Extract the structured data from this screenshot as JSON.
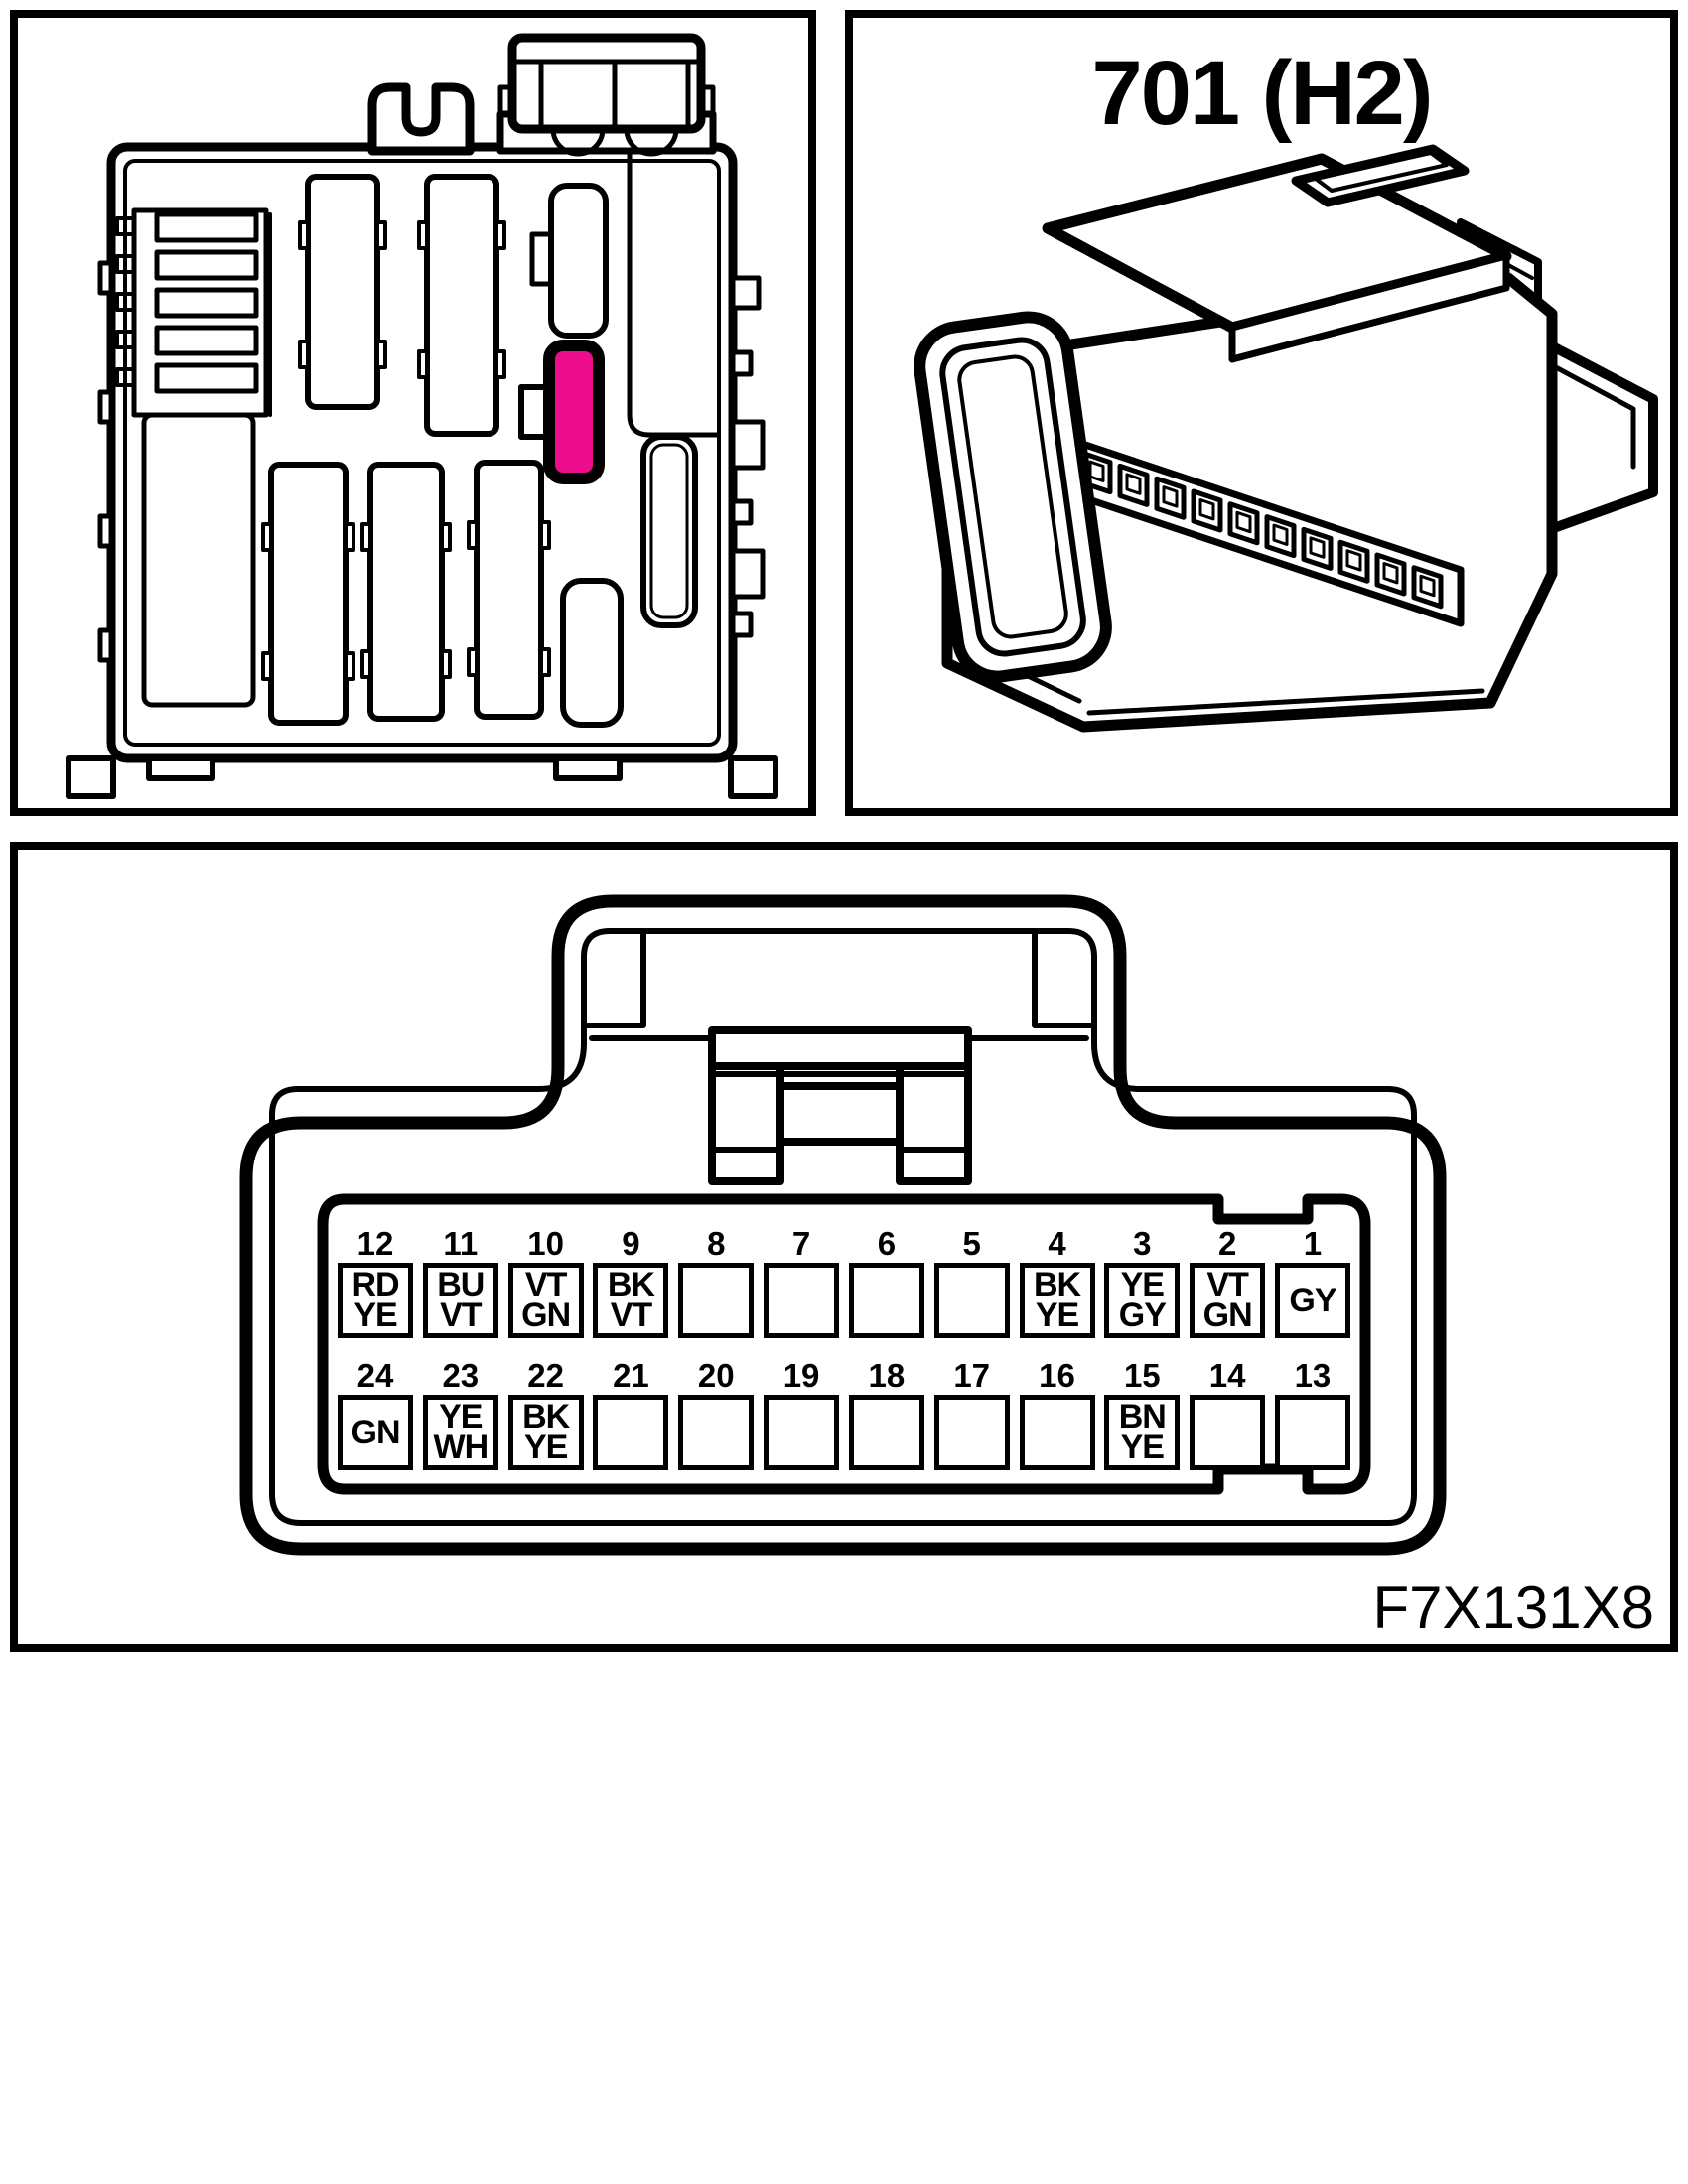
{
  "palette": {
    "line": "#000000",
    "background": "#ffffff",
    "highlight": "#EB0D8C"
  },
  "connector_photo": {
    "title": "701 (H2)"
  },
  "pinout": {
    "figure_code": "F7X131X8",
    "rows": [
      {
        "name": "upper",
        "pins": [
          {
            "n": "12",
            "lines": [
              "RD",
              "YE"
            ]
          },
          {
            "n": "11",
            "lines": [
              "BU",
              "VT"
            ]
          },
          {
            "n": "10",
            "lines": [
              "VT",
              "GN"
            ]
          },
          {
            "n": "9",
            "lines": [
              "BK",
              "VT"
            ]
          },
          {
            "n": "8",
            "lines": []
          },
          {
            "n": "7",
            "lines": []
          },
          {
            "n": "6",
            "lines": []
          },
          {
            "n": "5",
            "lines": []
          },
          {
            "n": "4",
            "lines": [
              "BK",
              "YE"
            ]
          },
          {
            "n": "3",
            "lines": [
              "YE",
              "GY"
            ]
          },
          {
            "n": "2",
            "lines": [
              "VT",
              "GN"
            ]
          },
          {
            "n": "1",
            "lines": [
              "GY"
            ]
          }
        ]
      },
      {
        "name": "lower",
        "pins": [
          {
            "n": "24",
            "lines": [
              "GN"
            ]
          },
          {
            "n": "23",
            "lines": [
              "YE",
              "WH"
            ]
          },
          {
            "n": "22",
            "lines": [
              "BK",
              "YE"
            ]
          },
          {
            "n": "21",
            "lines": []
          },
          {
            "n": "20",
            "lines": []
          },
          {
            "n": "19",
            "lines": []
          },
          {
            "n": "18",
            "lines": []
          },
          {
            "n": "17",
            "lines": []
          },
          {
            "n": "16",
            "lines": []
          },
          {
            "n": "15",
            "lines": [
              "BN",
              "YE"
            ]
          },
          {
            "n": "14",
            "lines": []
          },
          {
            "n": "13",
            "lines": []
          }
        ]
      }
    ]
  }
}
